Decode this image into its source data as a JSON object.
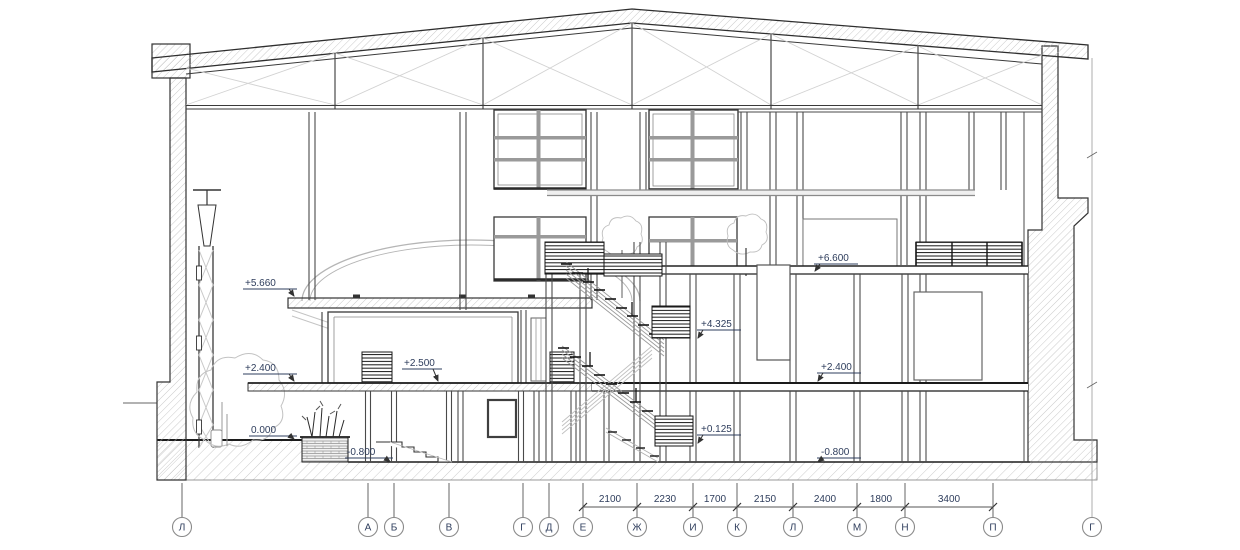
{
  "drawing": {
    "type": "architectural building section",
    "text_color": "#2e3d5c",
    "line_color": "#3a3a3a",
    "hatch_color": "#bdbdbd"
  },
  "elevation_marks": [
    {
      "id": "el-5660",
      "label": "+5.660"
    },
    {
      "id": "el-2400-left",
      "label": "+2.400"
    },
    {
      "id": "el-0000",
      "label": "0.000"
    },
    {
      "id": "el-m0800-left",
      "label": "-0.800"
    },
    {
      "id": "el-2500",
      "label": "+2.500"
    },
    {
      "id": "el-4325",
      "label": "+4.325"
    },
    {
      "id": "el-0125",
      "label": "+0.125"
    },
    {
      "id": "el-6600",
      "label": "+6.600"
    },
    {
      "id": "el-2400-right",
      "label": "+2.400"
    },
    {
      "id": "el-m0800-right",
      "label": "-0.800"
    }
  ],
  "grid_markers": [
    {
      "label": "Л"
    },
    {
      "label": "А"
    },
    {
      "label": "Б"
    },
    {
      "label": "В"
    },
    {
      "label": "Г"
    },
    {
      "label": "Д"
    },
    {
      "label": "Е"
    },
    {
      "label": "Ж"
    },
    {
      "label": "И"
    },
    {
      "label": "К"
    },
    {
      "label": "Л"
    },
    {
      "label": "М"
    },
    {
      "label": "Н"
    },
    {
      "label": "П"
    },
    {
      "label": "Г"
    }
  ],
  "dimensions": [
    {
      "label": "2100"
    },
    {
      "label": "2230"
    },
    {
      "label": "1700"
    },
    {
      "label": "2150"
    },
    {
      "label": "2400"
    },
    {
      "label": "1800"
    },
    {
      "label": "3400"
    }
  ]
}
